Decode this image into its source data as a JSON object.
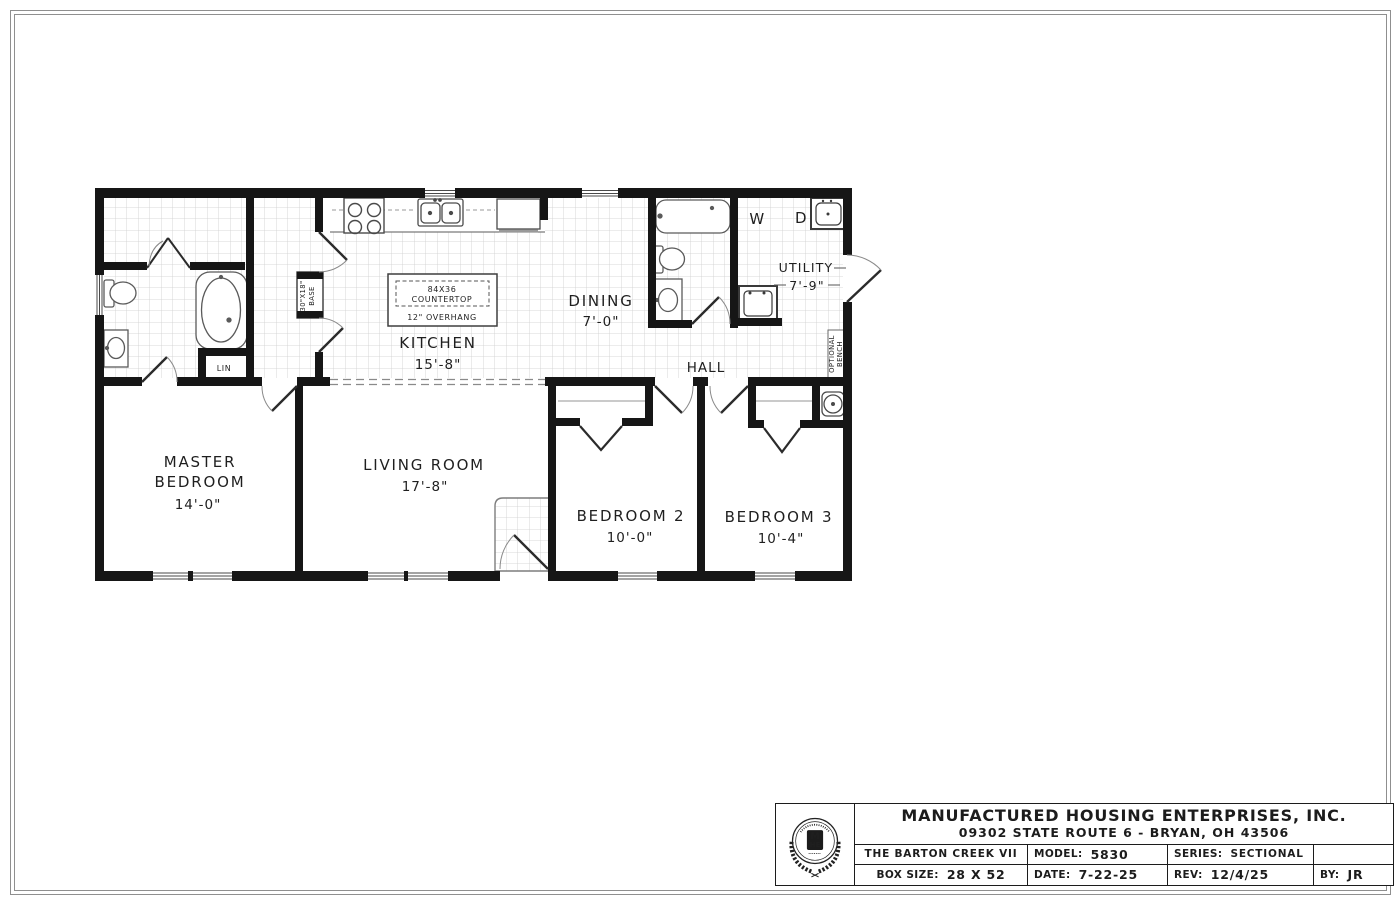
{
  "floor_plan": {
    "rooms": {
      "kitchen": {
        "name": "KITCHEN",
        "dim": "15'-8\""
      },
      "dining": {
        "name": "DINING",
        "dim": "7'-0\""
      },
      "hall": {
        "name": "HALL"
      },
      "utility": {
        "name": "UTILITY",
        "dim": "7'-9\""
      },
      "master_bedroom": {
        "line1": "MASTER",
        "line2": "BEDROOM",
        "dim": "14'-0\""
      },
      "living_room": {
        "name": "LIVING ROOM",
        "dim": "17'-8\""
      },
      "bedroom_2": {
        "name": "BEDROOM 2",
        "dim": "10'-0\""
      },
      "bedroom_3": {
        "name": "BEDROOM 3",
        "dim": "10'-4\""
      }
    },
    "annotations": {
      "island": {
        "line1": "84X36",
        "line2": "COUNTERTOP",
        "line3": "12\" OVERHANG"
      },
      "base_cabinet": {
        "line1": "30\"X18\"",
        "line2": "BASE"
      },
      "linen_closet": "LIN",
      "washer": "W",
      "dryer": "D",
      "bench": {
        "line1": "OPTIONAL",
        "line2": "BENCH"
      }
    }
  },
  "title_block": {
    "company": "MANUFACTURED HOUSING ENTERPRISES, INC.",
    "address": "09302 STATE ROUTE 6 - BRYAN, OH 43506",
    "plan_name": "THE BARTON CREEK VII",
    "model": {
      "label": "MODEL:",
      "value": "5830"
    },
    "series": {
      "label": "SERIES:",
      "value": "SECTIONAL"
    },
    "box_size": {
      "label": "BOX SIZE:",
      "value": "28 X 52"
    },
    "date": {
      "label": "DATE:",
      "value": "7-22-25"
    },
    "rev": {
      "label": "REV:",
      "value": "12/4/25"
    },
    "by": {
      "label": "BY:",
      "value": "JR"
    },
    "logo": {
      "monogram_top": "M",
      "monogram_bottom": "HE"
    }
  }
}
